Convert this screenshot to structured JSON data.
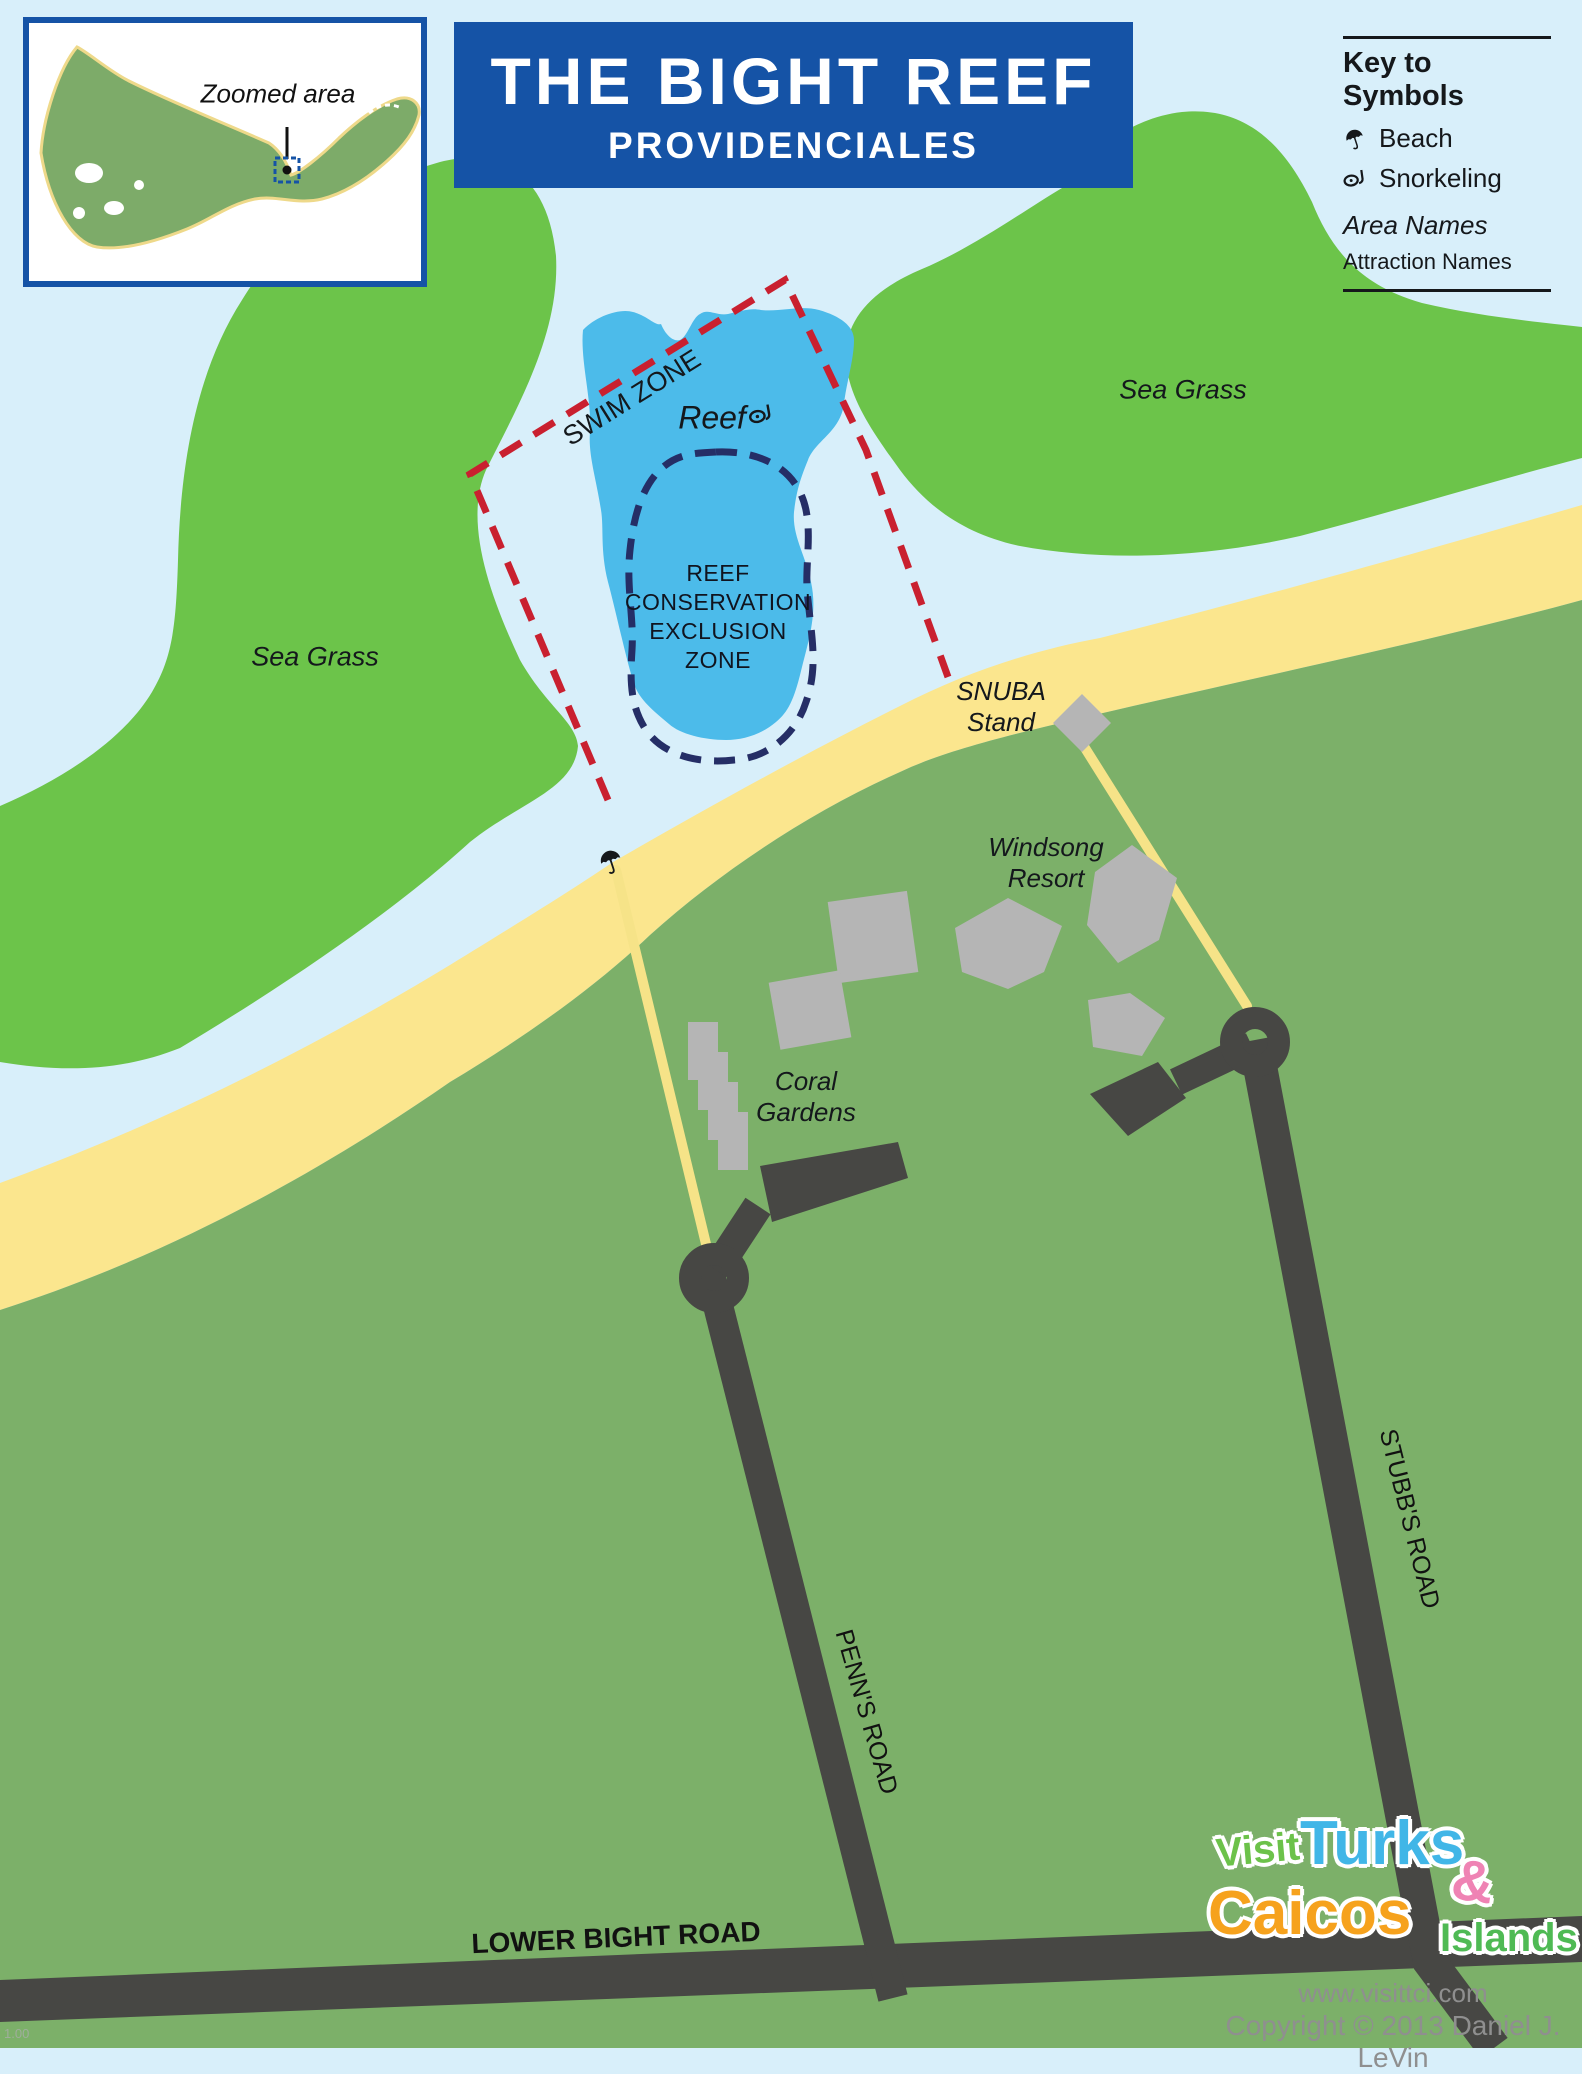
{
  "inset": {
    "label": "Zoomed area"
  },
  "banner": {
    "title": "THE BIGHT REEF",
    "subtitle": "PROVIDENCIALES"
  },
  "legend": {
    "title": "Key to Symbols",
    "items": [
      {
        "icon": "beach-umbrella-icon",
        "label": "Beach"
      },
      {
        "icon": "snorkel-icon",
        "label": "Snorkeling"
      }
    ],
    "area_names_label": "Area Names",
    "attraction_names_label": "Attraction Names"
  },
  "map": {
    "area_labels": [
      {
        "id": "sea-grass-left",
        "text": "Sea Grass"
      },
      {
        "id": "sea-grass-right",
        "text": "Sea Grass"
      }
    ],
    "swim_zone_label": "SWIM ZONE",
    "reef_label": "Reef",
    "exclusion_zone_lines": [
      "REEF",
      "CONSERVATION",
      "EXCLUSION",
      "ZONE"
    ],
    "attractions": [
      {
        "id": "snuba-stand",
        "line1": "SNUBA",
        "line2": "Stand"
      },
      {
        "id": "windsong-resort",
        "line1": "Windsong",
        "line2": "Resort"
      },
      {
        "id": "coral-gardens",
        "line1": "Coral",
        "line2": "Gardens"
      }
    ],
    "roads": [
      {
        "id": "penns-road",
        "name": "PENN'S ROAD"
      },
      {
        "id": "stubbs-road",
        "name": "STUBB'S ROAD"
      },
      {
        "id": "lower-bight-road",
        "name": "LOWER BIGHT ROAD"
      }
    ]
  },
  "footer": {
    "logo": {
      "visit": "Visit",
      "turks": "Turks",
      "ampersand": "&",
      "caicos": "Caicos",
      "islands": "Islands"
    },
    "website": "www.visittci.com",
    "copyright": "Copyright © 2013 Daniel J. LeVin",
    "version": "1.00"
  },
  "colors": {
    "ocean": "#d8effa",
    "sea_grass": "#6cc44a",
    "land": "#7cb069",
    "beach": "#fbe68e",
    "path": "#f6e388",
    "road": "#474744",
    "reef": "#4cbbea",
    "swim_zone_dash": "#c9202f",
    "exclusion_dash": "#252e66",
    "banner_blue": "#1553a6",
    "building": "#b5b5b5",
    "logo_visit": "#6cc24a",
    "logo_turks": "#41b6e7",
    "logo_amp": "#ef83b4",
    "logo_caicos": "#f6a21d",
    "logo_islands": "#4fba54",
    "footer_text": "#8f8f8f"
  }
}
